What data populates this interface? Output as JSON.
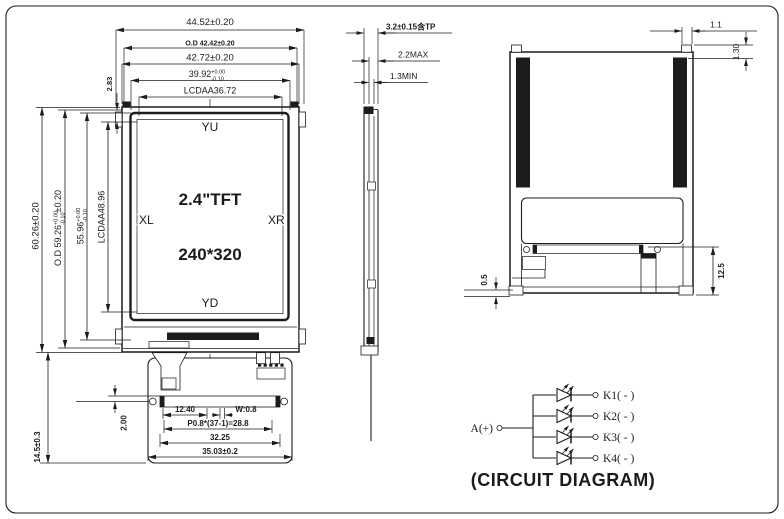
{
  "front": {
    "dims_top": {
      "overall": "44.52±0.20",
      "od": "O.D 42.42±0.20",
      "module": "42.72±0.20",
      "va": "39.92",
      "va_tol_up": "+0.00",
      "va_tol_dn": "-0.10",
      "aa": "LCDAA36.72"
    },
    "dims_left": {
      "overall": "60.26±0.20",
      "od": "O.D 59.26",
      "od_tol_up": "+0.00",
      "od_tol_dn": "-0.10",
      "od_suffix": "±0.20",
      "va": "55.96",
      "va_tol_up": "+0.00",
      "va_tol_dn": "-0.10",
      "aa": "LCDAA48.96",
      "margin": "2.83"
    },
    "screen": {
      "top": "YU",
      "left": "XL",
      "right": "XR",
      "bottom": "YD",
      "size": "2.4\"TFT",
      "resolution": "240*320"
    },
    "dims_bottom": {
      "fpc_len": "14.5±0.3",
      "pin_offset": "2.00",
      "lead_in": "12.40",
      "finger_w": "W:0.8",
      "pitch": "P0.8*(37-1)=28.8",
      "contact_span": "32.25",
      "fpc_w": "35.03±0.2"
    }
  },
  "side": {
    "total": "3.2±0.15含TP",
    "max": "2.2MAX",
    "min": "1.3MIN"
  },
  "back": {
    "tab_w": "1.1",
    "tab_h": "1.30",
    "fold_h": "12.5",
    "gap": "0.5"
  },
  "circuit": {
    "anode": "A(+)",
    "cathodes": [
      "K1( - )",
      "K2( - )",
      "K3( - )",
      "K4( - )"
    ],
    "caption": "(CIRCUIT DIAGRAM)"
  }
}
